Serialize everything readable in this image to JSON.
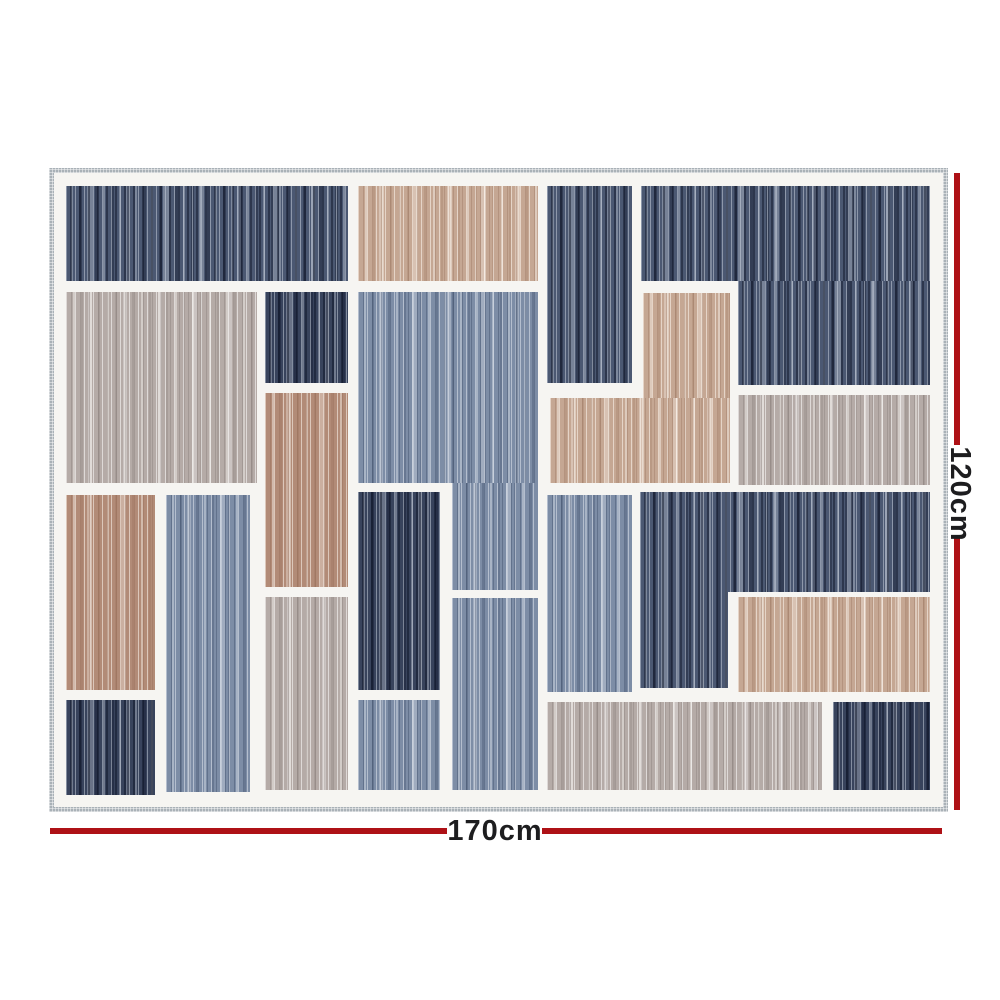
{
  "image": {
    "description": "Product photo of a rectangular geometric patchwork rug with vertical striped blocks and red dimension annotation lines",
    "width_label": "170cm",
    "height_label": "120cm"
  },
  "annotation": {
    "line_color": "#ae1116",
    "text_color": "#1d1d1f"
  },
  "rug": {
    "binding_color": "#a9b1b7",
    "gutter_color": "#f6f5f2",
    "palette": {
      "navy": "#4b5872",
      "navy_dark": "#38435c",
      "blue": "#7d8da6",
      "greige": "#b5aba7",
      "tan": "#b28b77",
      "tan_light": "#c5a793"
    },
    "blocks": [
      {
        "x": 0,
        "y": 0,
        "w": 282,
        "h": 95,
        "c": "navy"
      },
      {
        "x": 292,
        "y": 0,
        "w": 180,
        "h": 95,
        "c": "tan_light"
      },
      {
        "x": 481,
        "y": 0,
        "w": 85,
        "h": 197,
        "c": "navy"
      },
      {
        "x": 575,
        "y": 0,
        "w": 289,
        "h": 95,
        "c": "navy"
      },
      {
        "x": 672,
        "y": 95,
        "w": 192,
        "h": 104,
        "c": "navy"
      },
      {
        "x": 0,
        "y": 106,
        "w": 191,
        "h": 191,
        "c": "greige"
      },
      {
        "x": 199,
        "y": 106,
        "w": 83,
        "h": 91,
        "c": "navy_dark"
      },
      {
        "x": 199,
        "y": 207,
        "w": 83,
        "h": 194,
        "c": "tan"
      },
      {
        "x": 292,
        "y": 106,
        "w": 180,
        "h": 191,
        "c": "blue"
      },
      {
        "x": 386,
        "y": 297,
        "w": 86,
        "h": 107,
        "c": "blue"
      },
      {
        "x": 577,
        "y": 107,
        "w": 87,
        "h": 105,
        "c": "tan_light"
      },
      {
        "x": 484,
        "y": 212,
        "w": 180,
        "h": 85,
        "c": "tan_light"
      },
      {
        "x": 672,
        "y": 209,
        "w": 192,
        "h": 90,
        "c": "greige"
      },
      {
        "x": 0,
        "y": 309,
        "w": 89,
        "h": 195,
        "c": "tan"
      },
      {
        "x": 100,
        "y": 309,
        "w": 84,
        "h": 297,
        "c": "blue"
      },
      {
        "x": 199,
        "y": 411,
        "w": 83,
        "h": 193,
        "c": "greige"
      },
      {
        "x": 292,
        "y": 306,
        "w": 82,
        "h": 198,
        "c": "navy_dark"
      },
      {
        "x": 386,
        "y": 412,
        "w": 86,
        "h": 192,
        "c": "blue"
      },
      {
        "x": 481,
        "y": 309,
        "w": 85,
        "h": 197,
        "c": "blue"
      },
      {
        "x": 574,
        "y": 306,
        "w": 290,
        "h": 100,
        "c": "navy"
      },
      {
        "x": 574,
        "y": 406,
        "w": 88,
        "h": 96,
        "c": "navy"
      },
      {
        "x": 672,
        "y": 411,
        "w": 192,
        "h": 95,
        "c": "tan_light"
      },
      {
        "x": 0,
        "y": 514,
        "w": 89,
        "h": 95,
        "c": "navy_dark"
      },
      {
        "x": 292,
        "y": 514,
        "w": 82,
        "h": 90,
        "c": "blue"
      },
      {
        "x": 481,
        "y": 516,
        "w": 275,
        "h": 88,
        "c": "greige"
      },
      {
        "x": 767,
        "y": 516,
        "w": 97,
        "h": 88,
        "c": "navy_dark"
      }
    ]
  }
}
